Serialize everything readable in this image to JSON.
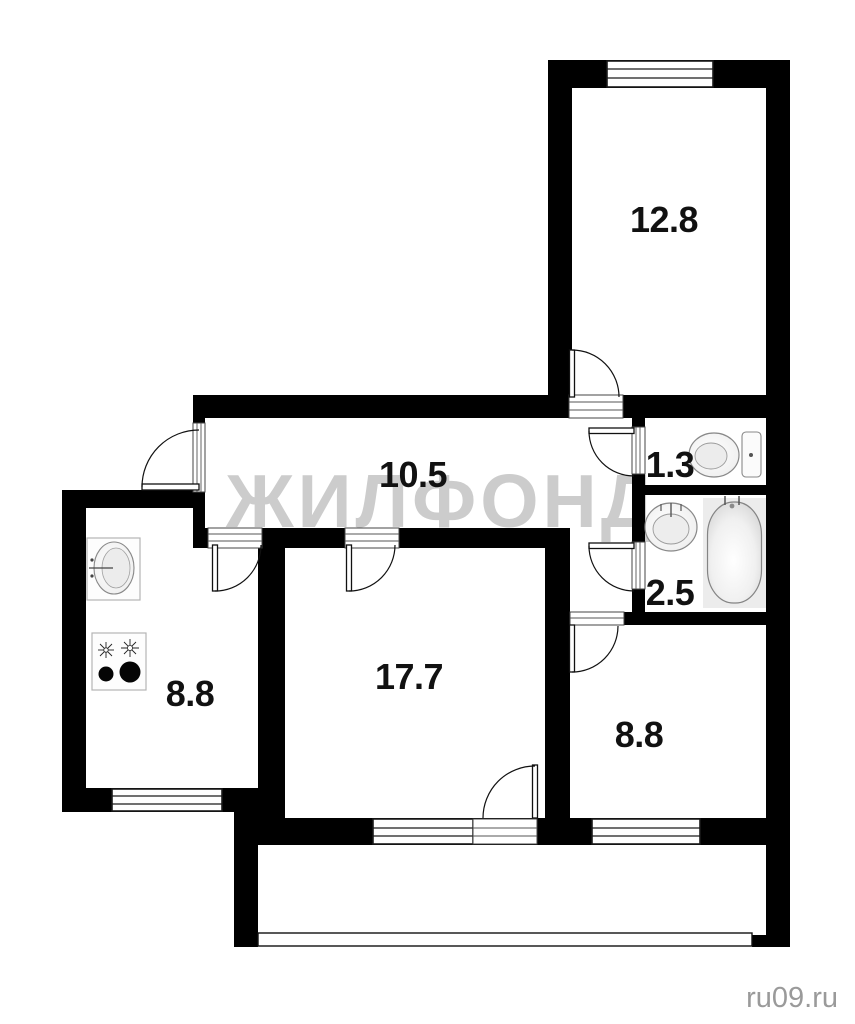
{
  "page": {
    "background": "#ffffff",
    "watermark": "ЖИЛФОНД",
    "credit": "ru09.ru"
  },
  "colors": {
    "wall": "#000000",
    "floor": "#ffffff",
    "room_label": "#111111",
    "watermark": "#cccccc",
    "credit": "#9a9a9a",
    "fixture_stroke": "#888888",
    "bathtub_area": "#ececec"
  },
  "rooms": [
    {
      "id": "bedroom-top",
      "area": "12.8"
    },
    {
      "id": "hallway",
      "area": "10.5"
    },
    {
      "id": "toilet",
      "area": "1.3"
    },
    {
      "id": "bathroom",
      "area": "2.5"
    },
    {
      "id": "living-room",
      "area": "17.7"
    },
    {
      "id": "kitchen",
      "area": "8.8"
    },
    {
      "id": "bedroom-bottom",
      "area": "8.8"
    }
  ],
  "icons": [
    {
      "name": "toilet-icon",
      "room": "toilet"
    },
    {
      "name": "washbasin-icon",
      "room": "bathroom"
    },
    {
      "name": "bathtub-icon",
      "room": "bathroom"
    },
    {
      "name": "kitchen-sink-icon",
      "room": "kitchen"
    },
    {
      "name": "stove-icon",
      "room": "kitchen"
    }
  ],
  "features": {
    "windows": 4,
    "doors": 8,
    "balcony": true
  }
}
